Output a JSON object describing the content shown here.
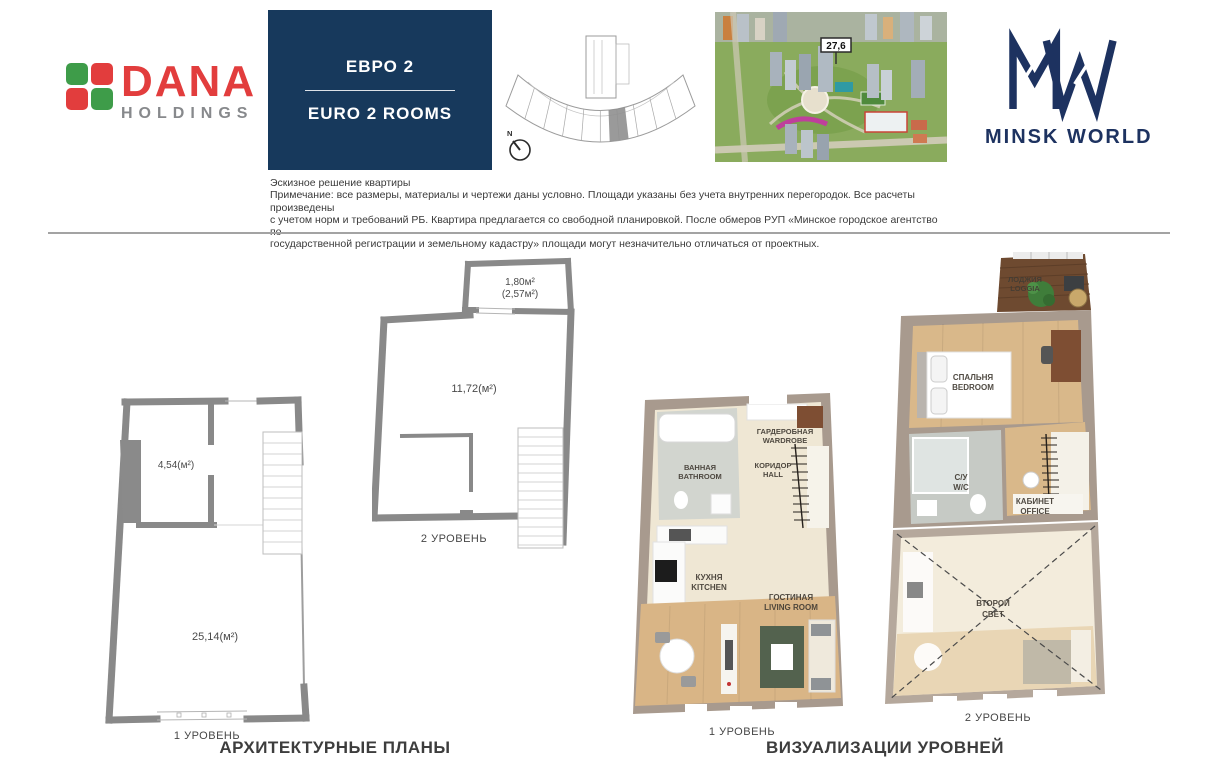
{
  "header": {
    "dana": {
      "name": "DANA",
      "sub": "HOLDINGS",
      "green": "#3e9c49",
      "red": "#e23d3d"
    },
    "unit_box": {
      "title_ru": "ЕВРО 2",
      "title_en": "EURO 2 ROOMS"
    },
    "key_plan": {
      "north_label": "N"
    },
    "aerial": {
      "marker": "27,6"
    },
    "brand": {
      "logo_text": "MINSK WORLD"
    }
  },
  "disclaimer": {
    "title": "Эскизное решение квартиры",
    "lines": [
      "Примечание: все размеры, материалы и чертежи даны условно. Площади указаны без учета внутренних перегородок. Все расчеты произведены",
      "с учетом норм и требований РБ. Квартира предлагается со свободной планировкой. После обмеров РУП «Минское городское агентство по",
      "государственной регистрации и земельному кадастру» площади могут незначительно отличаться от проектных."
    ]
  },
  "plans": {
    "section_title": "АРХИТЕКТУРНЫЕ ПЛАНЫ",
    "level1": {
      "caption": "1 УРОВЕНЬ",
      "area_main": "25,14(м²)",
      "area_small": "4,54(м²)"
    },
    "level2": {
      "caption": "2 УРОВЕНЬ",
      "area_main": "11,72(м²)",
      "area_balcony": "1,80м²",
      "area_balcony_full": "(2,57м²)"
    }
  },
  "viz": {
    "section_title": "ВИЗУАЛИЗАЦИИ УРОВНЕЙ",
    "level1": {
      "caption": "1 УРОВЕНЬ",
      "rooms": {
        "wardrobe": {
          "ru": "ГАРДЕРОБНАЯ",
          "en": "WARDROBE"
        },
        "bathroom": {
          "ru": "ВАННАЯ",
          "en": "BATHROOM"
        },
        "hall": {
          "ru": "КОРИДОР",
          "en": "HALL"
        },
        "kitchen": {
          "ru": "КУХНЯ",
          "en": "KITCHEN"
        },
        "living": {
          "ru": "ГОСТИНАЯ",
          "en": "LIVING ROOM"
        }
      }
    },
    "level2": {
      "caption": "2 УРОВЕНЬ",
      "rooms": {
        "loggia": {
          "ru": "ЛОДЖИЯ",
          "en": "LOGGIA"
        },
        "bedroom": {
          "ru": "СПАЛЬНЯ",
          "en": "BEDROOM"
        },
        "wc": {
          "ru": "С/У",
          "en": "W/C"
        },
        "office": {
          "ru": "КАБИНЕТ",
          "en": "OFFICE"
        },
        "void": {
          "ru": "ВТОРОЙ",
          "en": "СВЕТ"
        }
      }
    }
  }
}
